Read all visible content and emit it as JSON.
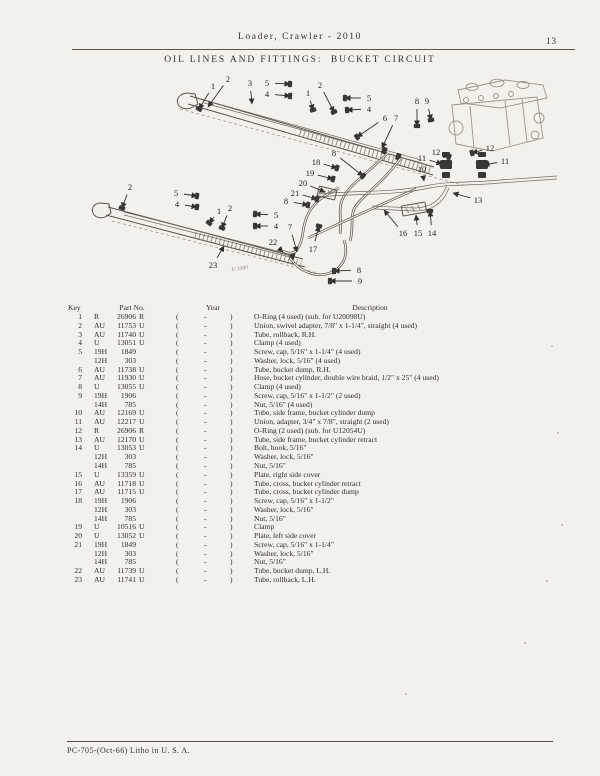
{
  "header": {
    "doc_title": "Loader, Crawler - 2010",
    "page_number": "13"
  },
  "section_title": "OIL LINES AND FITTINGS:  BUCKET CIRCUIT",
  "footer": {
    "imprint": "PC-705-(Oct-66) Litho in U. S. A."
  },
  "diagram": {
    "figure_ref": "U 3380",
    "callouts": [
      {
        "n": "1",
        "x": 213,
        "y": 86,
        "tx": 199,
        "ty": 109,
        "b": 1
      },
      {
        "n": "2",
        "x": 228,
        "y": 79,
        "tx": 208,
        "ty": 107,
        "b": 0
      },
      {
        "n": "3",
        "x": 250,
        "y": 83,
        "tx": 252,
        "ty": 104,
        "b": 0
      },
      {
        "n": "5",
        "x": 267,
        "y": 83,
        "tx": 290,
        "ty": 84,
        "b": 1
      },
      {
        "n": "4",
        "x": 267,
        "y": 94,
        "tx": 290,
        "ty": 96,
        "b": 1
      },
      {
        "n": "1",
        "x": 308,
        "y": 93,
        "tx": 313,
        "ty": 110,
        "b": 1
      },
      {
        "n": "2",
        "x": 320,
        "y": 85,
        "tx": 334,
        "ty": 112,
        "b": 1
      },
      {
        "n": "5",
        "x": 369,
        "y": 98,
        "tx": 345,
        "ty": 98,
        "b": 1
      },
      {
        "n": "4",
        "x": 369,
        "y": 109,
        "tx": 347,
        "ty": 110,
        "b": 1
      },
      {
        "n": "6",
        "x": 385,
        "y": 118,
        "tx": 357,
        "ty": 137,
        "b": 1
      },
      {
        "n": "7",
        "x": 396,
        "y": 118,
        "tx": 382,
        "ty": 148,
        "b": 0
      },
      {
        "n": "8",
        "x": 417,
        "y": 101,
        "tx": 417,
        "ty": 126,
        "b": 1
      },
      {
        "n": "9",
        "x": 427,
        "y": 101,
        "tx": 431,
        "ty": 120,
        "b": 1
      },
      {
        "n": "12",
        "x": 436,
        "y": 152,
        "tx": 449,
        "ty": 157,
        "b": 1
      },
      {
        "n": "12",
        "x": 490,
        "y": 148,
        "tx": 472,
        "ty": 153,
        "b": 1
      },
      {
        "n": "11",
        "x": 422,
        "y": 158,
        "tx": 442,
        "ty": 164,
        "b": 1
      },
      {
        "n": "11",
        "x": 505,
        "y": 161,
        "tx": 484,
        "ty": 165,
        "b": 1
      },
      {
        "n": "10",
        "x": 422,
        "y": 169,
        "tx": 424,
        "ty": 181,
        "b": 0
      },
      {
        "n": "13",
        "x": 478,
        "y": 200,
        "tx": 453,
        "ty": 193,
        "b": 0
      },
      {
        "n": "8",
        "x": 334,
        "y": 153,
        "tx": 363,
        "ty": 176,
        "b": 1
      },
      {
        "n": "18",
        "x": 316,
        "y": 162,
        "tx": 337,
        "ty": 168,
        "b": 1
      },
      {
        "n": "19",
        "x": 310,
        "y": 173,
        "tx": 333,
        "ty": 179,
        "b": 1
      },
      {
        "n": "20",
        "x": 303,
        "y": 183,
        "tx": 325,
        "ty": 192,
        "b": 0
      },
      {
        "n": "21",
        "x": 295,
        "y": 193,
        "tx": 317,
        "ty": 199,
        "b": 1
      },
      {
        "n": "8",
        "x": 286,
        "y": 201,
        "tx": 308,
        "ty": 205,
        "b": 1
      },
      {
        "n": "2",
        "x": 130,
        "y": 187,
        "tx": 122,
        "ty": 208,
        "b": 1
      },
      {
        "n": "5",
        "x": 176,
        "y": 193,
        "tx": 197,
        "ty": 196,
        "b": 1
      },
      {
        "n": "4",
        "x": 177,
        "y": 204,
        "tx": 197,
        "ty": 207,
        "b": 1
      },
      {
        "n": "1",
        "x": 219,
        "y": 211,
        "tx": 209,
        "ty": 223,
        "b": 1
      },
      {
        "n": "2",
        "x": 230,
        "y": 208,
        "tx": 222,
        "ty": 228,
        "b": 1
      },
      {
        "n": "5",
        "x": 276,
        "y": 215,
        "tx": 255,
        "ty": 214,
        "b": 1
      },
      {
        "n": "4",
        "x": 276,
        "y": 226,
        "tx": 255,
        "ty": 226,
        "b": 1
      },
      {
        "n": "22",
        "x": 273,
        "y": 242,
        "tx": 283,
        "ty": 252,
        "b": 0
      },
      {
        "n": "7",
        "x": 290,
        "y": 227,
        "tx": 297,
        "ty": 252,
        "b": 0
      },
      {
        "n": "23",
        "x": 213,
        "y": 265,
        "tx": 224,
        "ty": 246,
        "b": 0
      },
      {
        "n": "17",
        "x": 313,
        "y": 249,
        "tx": 319,
        "ty": 226,
        "b": 1
      },
      {
        "n": "16",
        "x": 403,
        "y": 233,
        "tx": 384,
        "ty": 210,
        "b": 0
      },
      {
        "n": "15",
        "x": 418,
        "y": 233,
        "tx": 416,
        "ty": 215,
        "b": 0
      },
      {
        "n": "14",
        "x": 432,
        "y": 233,
        "tx": 430,
        "ty": 211,
        "b": 1
      },
      {
        "n": "8",
        "x": 359,
        "y": 270,
        "tx": 334,
        "ty": 271,
        "b": 1
      },
      {
        "n": "9",
        "x": 360,
        "y": 281,
        "tx": 330,
        "ty": 281,
        "b": 1
      }
    ]
  },
  "table": {
    "headers": {
      "key": "Key",
      "part_no": "Part No.",
      "year": "Year",
      "description": "Description"
    },
    "year_placeholder": {
      "open": "(",
      "dash": "-",
      "close": ")"
    },
    "rows": [
      {
        "key": "1",
        "prefix": "R",
        "number": "26906",
        "suffix": "R",
        "description": "O-Ring (4 used) (sub. for U20098U)"
      },
      {
        "key": "2",
        "prefix": "AU",
        "number": "11753",
        "suffix": "U",
        "description": "Union, swivel adapter, 7/8\" x 1-1/4\", straight (4 used)"
      },
      {
        "key": "3",
        "prefix": "AU",
        "number": "11740",
        "suffix": "U",
        "description": "Tube, rollback, R.H."
      },
      {
        "key": "4",
        "prefix": "U",
        "number": "13051",
        "suffix": "U",
        "description": "Clamp (4 used)"
      },
      {
        "key": "5",
        "prefix": "19H",
        "number": "1849",
        "suffix": "",
        "description": "Screw, cap, 5/16\" x 1-1/4\" (4 used)"
      },
      {
        "key": "",
        "prefix": "12H",
        "number": "303",
        "suffix": "",
        "description": "Washer, lock, 5/16\" (4 used)"
      },
      {
        "key": "6",
        "prefix": "AU",
        "number": "11738",
        "suffix": "U",
        "description": "Tube, bucket dump, R.H."
      },
      {
        "key": "7",
        "prefix": "AU",
        "number": "11930",
        "suffix": "U",
        "description": "Hose, bucket cylinder, double wire braid, 1/2\" x 25\" (4 used)"
      },
      {
        "key": "8",
        "prefix": "U",
        "number": "13055",
        "suffix": "U",
        "description": "Clamp (4 used)"
      },
      {
        "key": "9",
        "prefix": "19H",
        "number": "1906",
        "suffix": "",
        "description": "Screw, cap, 5/16\" x 1-1/2\" (2 used)"
      },
      {
        "key": "",
        "prefix": "14H",
        "number": "785",
        "suffix": "",
        "description": "Nut, 5/16\" (4 used)"
      },
      {
        "key": "10",
        "prefix": "AU",
        "number": "12169",
        "suffix": "U",
        "description": "Tube, side frame, bucket cylinder dump"
      },
      {
        "key": "11",
        "prefix": "AU",
        "number": "12217",
        "suffix": "U",
        "description": "Union, adapter, 3/4\" x 7/8\", straight (2 used)"
      },
      {
        "key": "12",
        "prefix": "R",
        "number": "26906",
        "suffix": "R",
        "description": "O-Ring (2 used) (sub. for U12054U)"
      },
      {
        "key": "13",
        "prefix": "AU",
        "number": "12170",
        "suffix": "U",
        "description": "Tube, side frame, bucket cylinder retract"
      },
      {
        "key": "14",
        "prefix": "U",
        "number": "13053",
        "suffix": "U",
        "description": "Bolt, hook, 5/16\""
      },
      {
        "key": "",
        "prefix": "12H",
        "number": "303",
        "suffix": "",
        "description": "Washer, lock, 5/16\""
      },
      {
        "key": "",
        "prefix": "14H",
        "number": "785",
        "suffix": "",
        "description": "Nut, 5/16\""
      },
      {
        "key": "15",
        "prefix": "U",
        "number": "13359",
        "suffix": "U",
        "description": "Plate, right side cover"
      },
      {
        "key": "16",
        "prefix": "AU",
        "number": "11718",
        "suffix": "U",
        "description": "Tube, cross, bucket cylinder retract"
      },
      {
        "key": "17",
        "prefix": "AU",
        "number": "11715",
        "suffix": "U",
        "description": "Tube, cross, bucket cylinder dump"
      },
      {
        "key": "18",
        "prefix": "19H",
        "number": "1906",
        "suffix": "",
        "description": "Screw, cap, 5/16\" x 1-1/2\""
      },
      {
        "key": "",
        "prefix": "12H",
        "number": "303",
        "suffix": "",
        "description": "Washer, lock, 5/16\""
      },
      {
        "key": "",
        "prefix": "14H",
        "number": "785",
        "suffix": "",
        "description": "Nut, 5/16\""
      },
      {
        "key": "19",
        "prefix": "U",
        "number": "10516",
        "suffix": "U",
        "description": "Clamp"
      },
      {
        "key": "20",
        "prefix": "U",
        "number": "13052",
        "suffix": "U",
        "description": "Plate, left side cover"
      },
      {
        "key": "21",
        "prefix": "19H",
        "number": "1849",
        "suffix": "",
        "description": "Screw, cap, 5/16\" x 1-1/4\""
      },
      {
        "key": "",
        "prefix": "12H",
        "number": "303",
        "suffix": "",
        "description": "Washer, lock, 5/16\""
      },
      {
        "key": "",
        "prefix": "14H",
        "number": "785",
        "suffix": "",
        "description": "Nut, 5/16\""
      },
      {
        "key": "22",
        "prefix": "AU",
        "number": "11739",
        "suffix": "U",
        "description": "Tube, bucket dump, L.H."
      },
      {
        "key": "23",
        "prefix": "AU",
        "number": "11741",
        "suffix": "U",
        "description": "Tube, rollback, L.H."
      }
    ]
  }
}
